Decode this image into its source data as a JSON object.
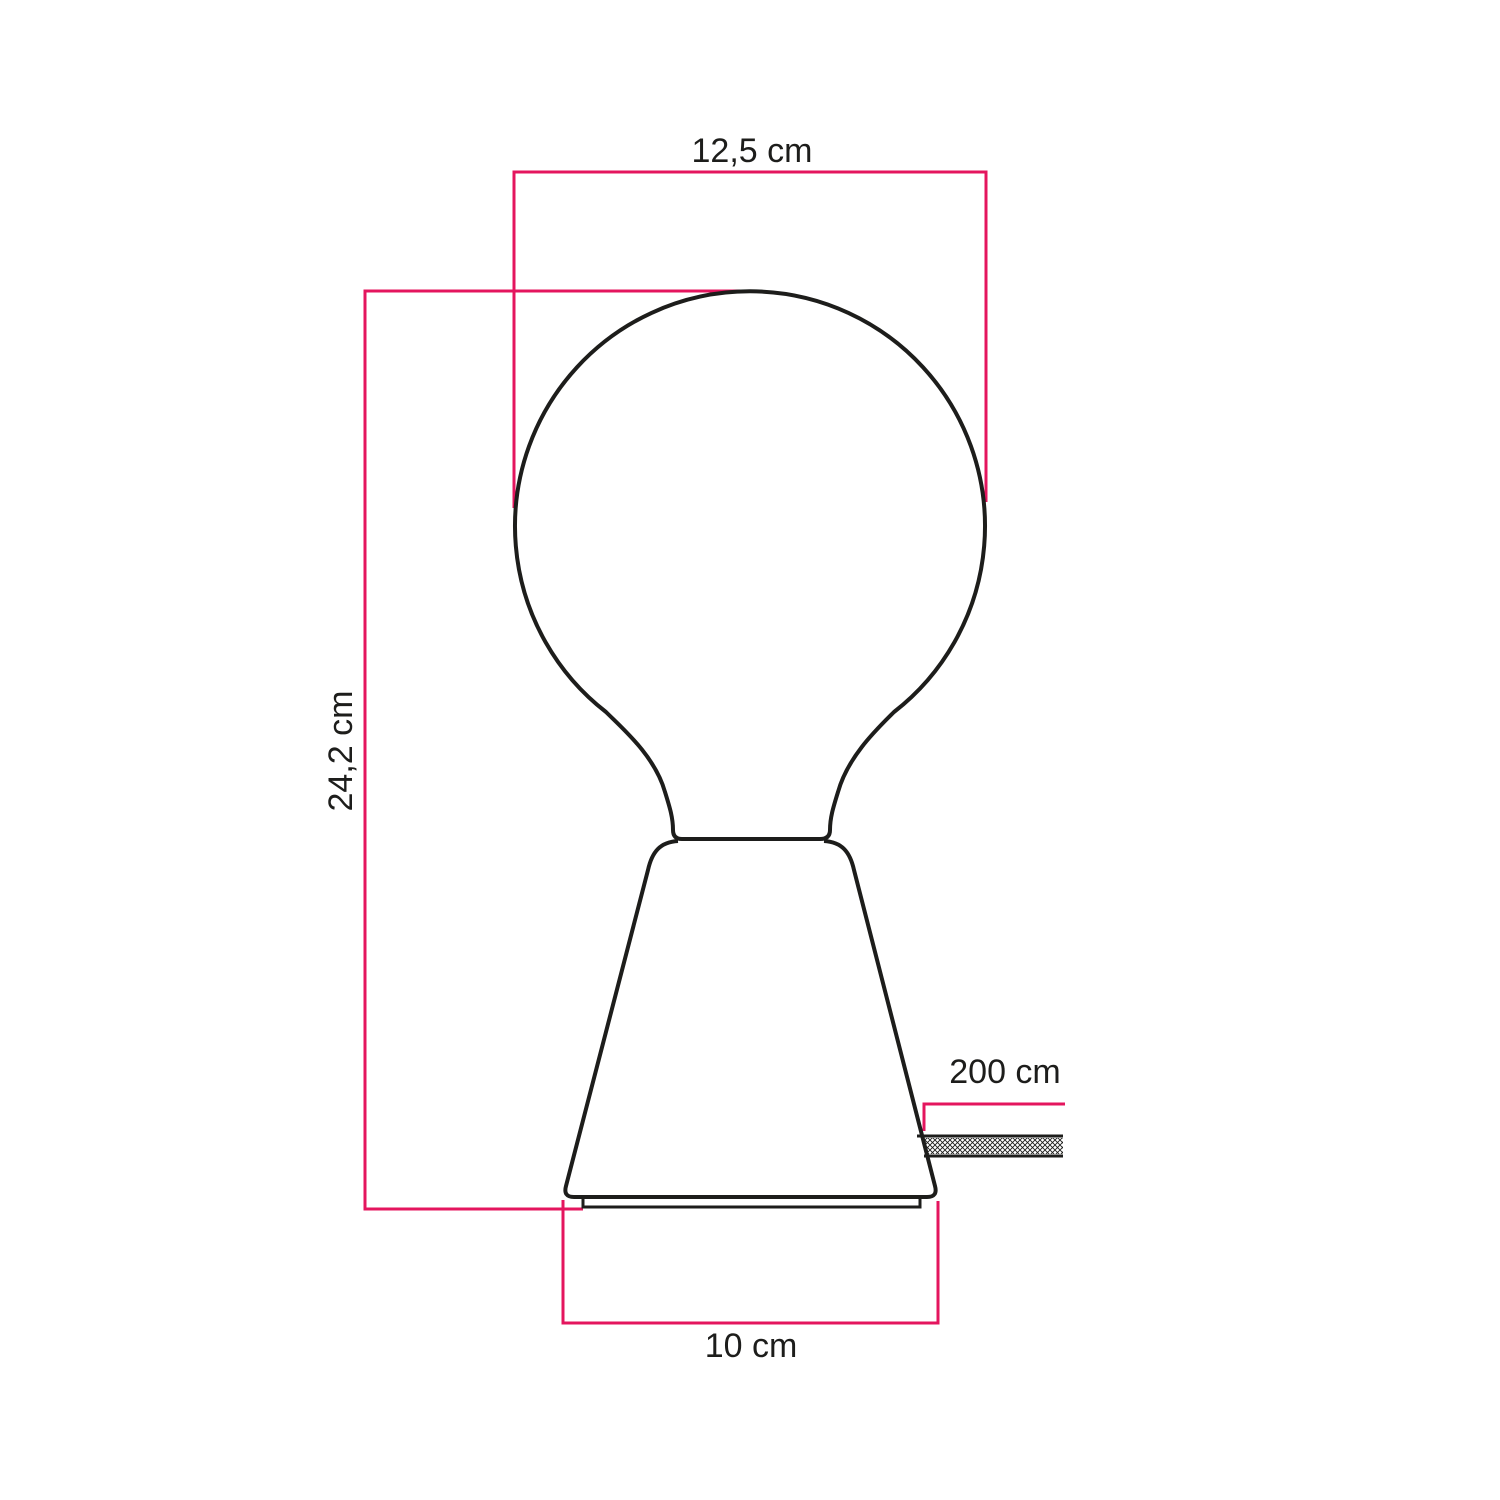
{
  "colors": {
    "dimension_line": "#e4155e",
    "outline": "#1d1d1b",
    "text": "#1d1d1b",
    "background": "#ffffff"
  },
  "dimensions": {
    "bulb_diameter": {
      "label": "12,5 cm",
      "value": "12,5",
      "unit": "cm"
    },
    "total_height": {
      "label": "24,2 cm",
      "value": "24,2",
      "unit": "cm"
    },
    "cable_length": {
      "label": "200 cm",
      "value": "200",
      "unit": "cm"
    },
    "base_diameter": {
      "label": "10 cm",
      "value": "10",
      "unit": "cm"
    }
  }
}
